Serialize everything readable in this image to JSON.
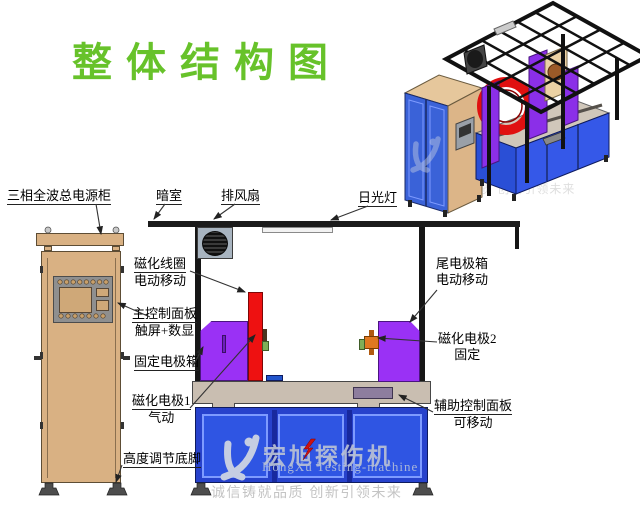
{
  "title": "整体结构图",
  "labels": {
    "power_cabinet": {
      "text": "三相全波总电源柜"
    },
    "darkroom": {
      "text": "暗室"
    },
    "exhaust_fan": {
      "text": "排风扇"
    },
    "fluorescent_lamp": {
      "text": "日光灯"
    },
    "magnetizing_coil": {
      "line1": "磁化线圈",
      "line2": "电动移动"
    },
    "main_control_panel": {
      "line1": "主控制面板",
      "line2": "触屏+数显"
    },
    "fixed_electrode_box": {
      "text": "固定电极箱"
    },
    "magnetizing_electrode_1": {
      "line1": "磁化电极1",
      "line2": "气动"
    },
    "height_adjust_feet": {
      "text": "高度调节底脚"
    },
    "tail_electrode_box": {
      "line1": "尾电极箱",
      "line2": "电动移动"
    },
    "magnetizing_electrode_2": {
      "line1": "磁化电极2",
      "line2": "固定"
    },
    "aux_control_panel": {
      "line1": "辅助控制面板",
      "line2": "可移动"
    }
  },
  "watermark": {
    "brand_cn": "宏旭探伤机",
    "brand_en": "HongXu Testing-machine",
    "tagline": "诚信铸就品质 创新引领未来"
  },
  "colors": {
    "title_green": "#67c22a",
    "cabinet_tan": "#d9b183",
    "electrode_purple": "#9a31f5",
    "coil_red": "#ee1111",
    "machine_blue": "#2742cc",
    "table_gray": "#c9beb1",
    "electrode_orange": "#e07820",
    "frame_black": "#1b1b1b"
  }
}
